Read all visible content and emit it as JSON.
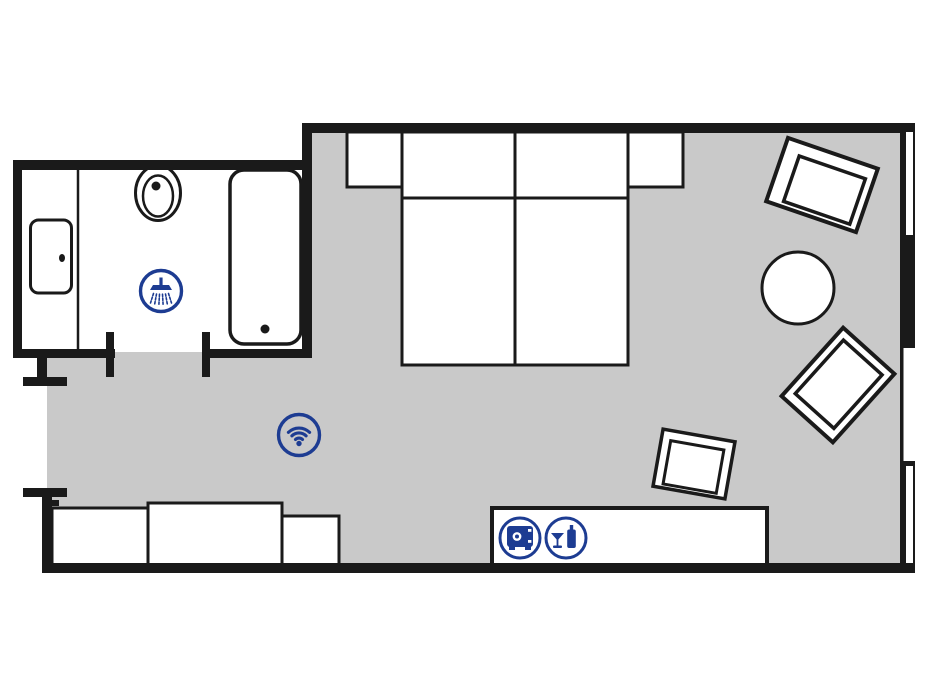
{
  "title": "Hotel room floor plan",
  "colors": {
    "wall": "#1a1a1a",
    "floor": "#c9c9c9",
    "accent": "#1d3c92",
    "paper": "#ffffff",
    "furn": "#ffffff"
  },
  "amenities": [
    {
      "name": "shower-icon",
      "meaning": "Shower",
      "location": "bathroom"
    },
    {
      "name": "wifi-icon",
      "meaning": "WiFi",
      "location": "bedroom"
    },
    {
      "name": "safe-icon",
      "meaning": "In-room safe",
      "location": "sideboard"
    },
    {
      "name": "minibar-icon",
      "meaning": "Minibar",
      "location": "sideboard"
    }
  ],
  "rooms": {
    "bathroom": {
      "fixtures": [
        "sink",
        "toilet",
        "bathtub"
      ]
    },
    "bedroom": {
      "furniture": [
        "nightstand-left",
        "double-bed",
        "nightstand-right",
        "armchair-top",
        "round-table",
        "armchair-bottom",
        "small-chair",
        "sideboard",
        "desk-left",
        "desk-center",
        "desk-right"
      ],
      "windows": 3,
      "doors": [
        "entry-door",
        "bathroom-door"
      ]
    }
  }
}
